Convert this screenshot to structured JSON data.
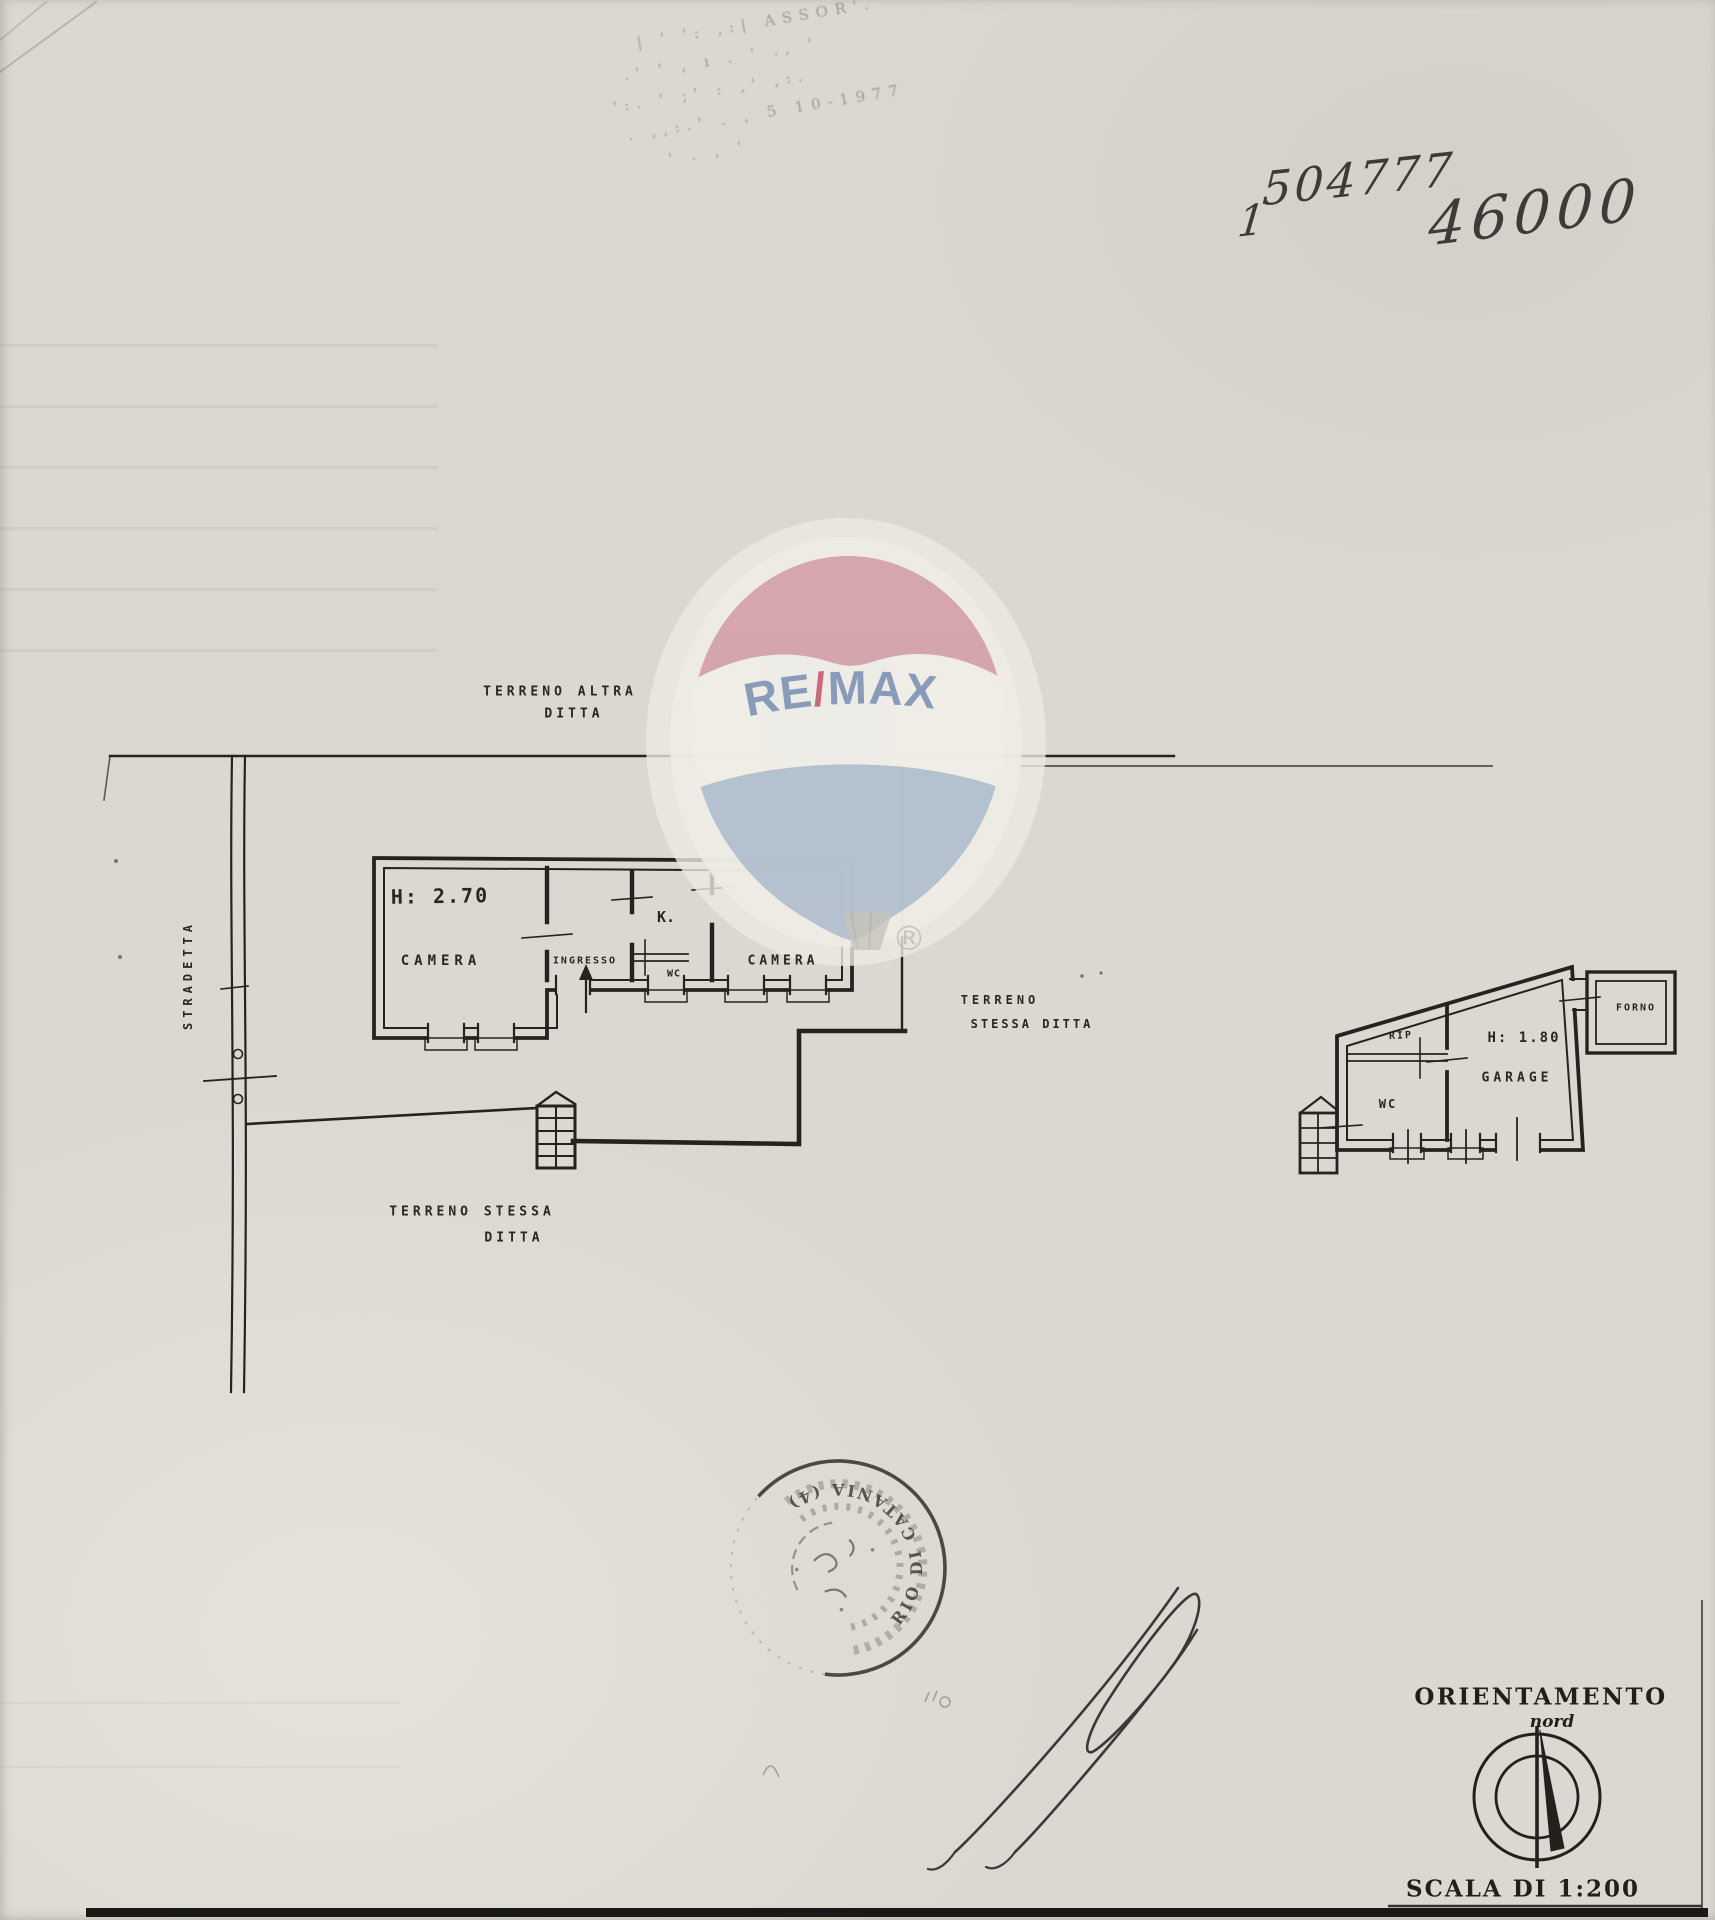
{
  "page": {
    "background_color": "#dcd8d1",
    "ink_color": "#26231e"
  },
  "handwriting": {
    "number_main": "504777",
    "number_small": "1",
    "number_right": "46000"
  },
  "faded_stamp": {
    "rows": [
      "´ '' ¹  ''' ' |",
      "| ' ':  ,:| ASSOR'.",
      ".' ' ,  ı . ' ., '",
      "':. ' ;'   : ,' ,:.",
      ". ,,:.'  . , 5 10-1977",
      "' .   , '"
    ]
  },
  "watermark": {
    "brand_re": "RE",
    "brand_slash": "/",
    "brand_max": "MAX",
    "registered": "®",
    "colors": {
      "top_band": "#cf96a0",
      "middle_band": "#efede7",
      "bottom_band": "#a8b7ca",
      "letters": "#8096b6",
      "slash": "#c2626f"
    }
  },
  "site_plan": {
    "label_terreno_altra_1": "TERRENO ALTRA",
    "label_terreno_altra_2": "DITTA",
    "label_stradetta": "STRADETTA",
    "label_terreno_stessa_right_1": "TERRENO",
    "label_terreno_stessa_right_2": "STESSA DITTA",
    "label_terreno_stessa_bottom_1": "TERRENO STESSA",
    "label_terreno_stessa_bottom_2": "DITTA",
    "house": {
      "height_note": "H: 2.70",
      "room_camera_left": "CAMERA",
      "room_ingresso": "INGRESSO",
      "room_kitchen": "K.",
      "room_wc": "WC",
      "room_camera_right": "CAMERA"
    },
    "annex": {
      "height_note": "H: 1.80",
      "room_rip": "RIP",
      "room_wc": "WC",
      "room_garage": "GARAGE",
      "room_forno": "FORNO"
    }
  },
  "round_stamp": {
    "arc_text": "RIO DI CATANIA (4)"
  },
  "footer": {
    "orientation_title": "ORIENTAMENTO",
    "orientation_sub": "nord",
    "scale_text": "SCALA DI 1:200"
  }
}
